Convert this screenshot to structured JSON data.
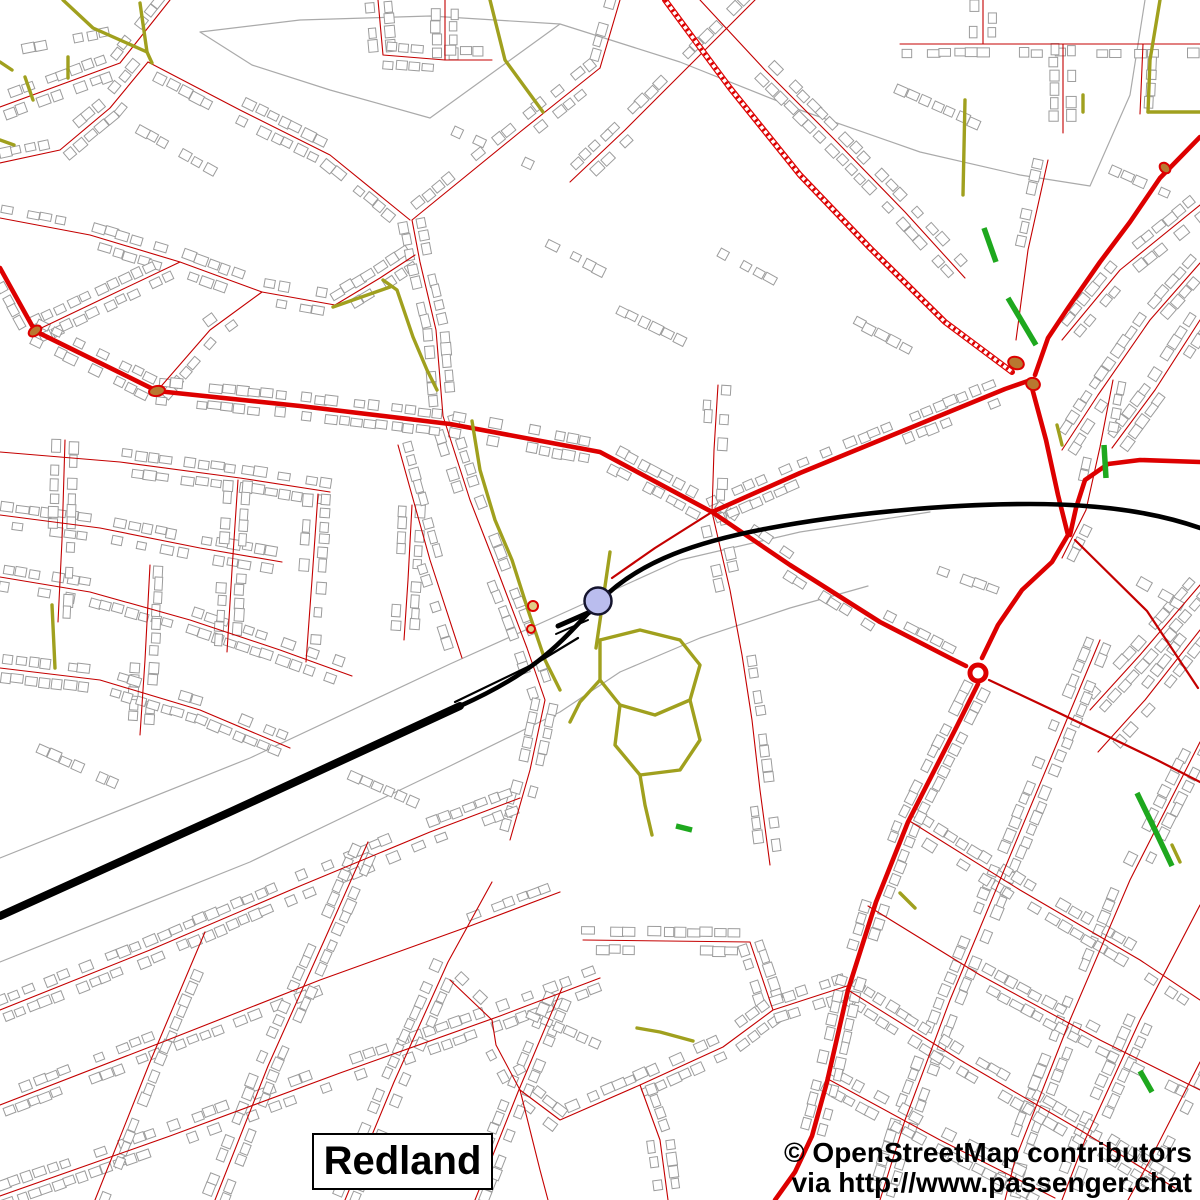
{
  "map": {
    "place_label": "Redland",
    "attribution_line1": "© OpenStreetMap contributors",
    "attribution_line2": "via http://www.passenger.chat"
  },
  "markers": {
    "station": {
      "name": "railway-station-marker",
      "shape": "circle"
    },
    "roundabout": {
      "name": "roundabout-marker",
      "shape": "ring"
    }
  },
  "colors": {
    "background": "#ffffff",
    "road_primary": "#dd0000",
    "road_minor": "#c40000",
    "path_olive": "#a0a01e",
    "bus_lane_green": "#1ea81e",
    "railway": "#000000",
    "station_fill": "#babdee",
    "station_stroke": "#15152e",
    "building_outline": "#9c9c9c",
    "boundary_gray": "#aaaaaa",
    "junction_node_fill": "#b87830",
    "small_node_fill": "#e0cc88",
    "text": "#000000"
  }
}
